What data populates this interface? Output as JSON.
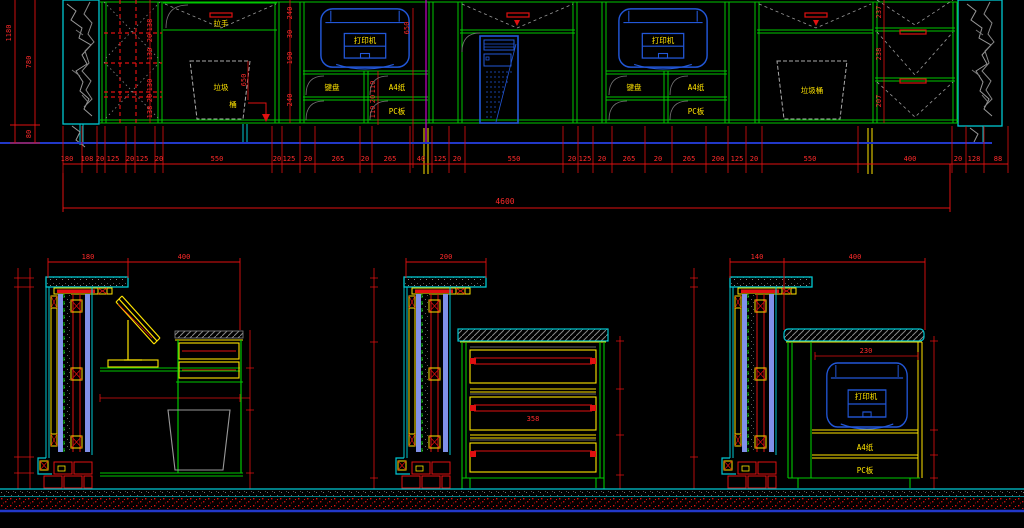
{
  "drawing": {
    "colors": {
      "background": "#000000",
      "frame_green": "#00c800",
      "dim_red": "#e01010",
      "outline_cyan": "#00c8d2",
      "device_blue": "#2257d8",
      "label_yellow": "#ffe400",
      "grid_magenta": "#c400c4",
      "floor_blue": "#2238c8",
      "rock_gray": "#999999",
      "panel_periwinkle": "#8090e8"
    },
    "elevation": {
      "left_dims": {
        "total": "1180",
        "upper": "780",
        "lower": "80"
      },
      "lattice_dims": [
        "138",
        "20",
        "130",
        "130",
        "20",
        "138"
      ],
      "shelf_col_dims": [
        "240",
        "30",
        "190",
        "240"
      ],
      "handle_label": "拉手",
      "bin_label_1": "垃圾",
      "bin_label_2": "桶",
      "bin_dim": "650",
      "niche_dim": "650",
      "printer_label": "打印机",
      "keyboard_label": "键盘",
      "a4_label": "A4纸",
      "pc_label": "PC板",
      "mid_shelf_dims": [
        "110",
        "20",
        "110"
      ],
      "bin2_label": "垃圾桶",
      "drawer_dims": [
        "237",
        "238",
        "207"
      ],
      "bottom_dims": [
        "180",
        "108",
        "20",
        "125",
        "20",
        "125",
        "20",
        "550",
        "20",
        "125",
        "20",
        "265",
        "20",
        "265",
        "40",
        "125",
        "20",
        "550",
        "20",
        "125",
        "20",
        "265",
        "20",
        "265",
        "200",
        "125",
        "20",
        "550",
        "400",
        "20",
        "128",
        "88"
      ],
      "total_dim": "4600"
    },
    "details": {
      "a": {
        "top_w1": "180",
        "top_w2": "400"
      },
      "b": {
        "top_w": "200",
        "drawer_dim": "358"
      },
      "c": {
        "top_w1": "140",
        "top_w2": "400",
        "inner_w": "230",
        "printer_label": "打印机",
        "a4_label": "A4纸",
        "pc_label": "PC板"
      }
    }
  }
}
